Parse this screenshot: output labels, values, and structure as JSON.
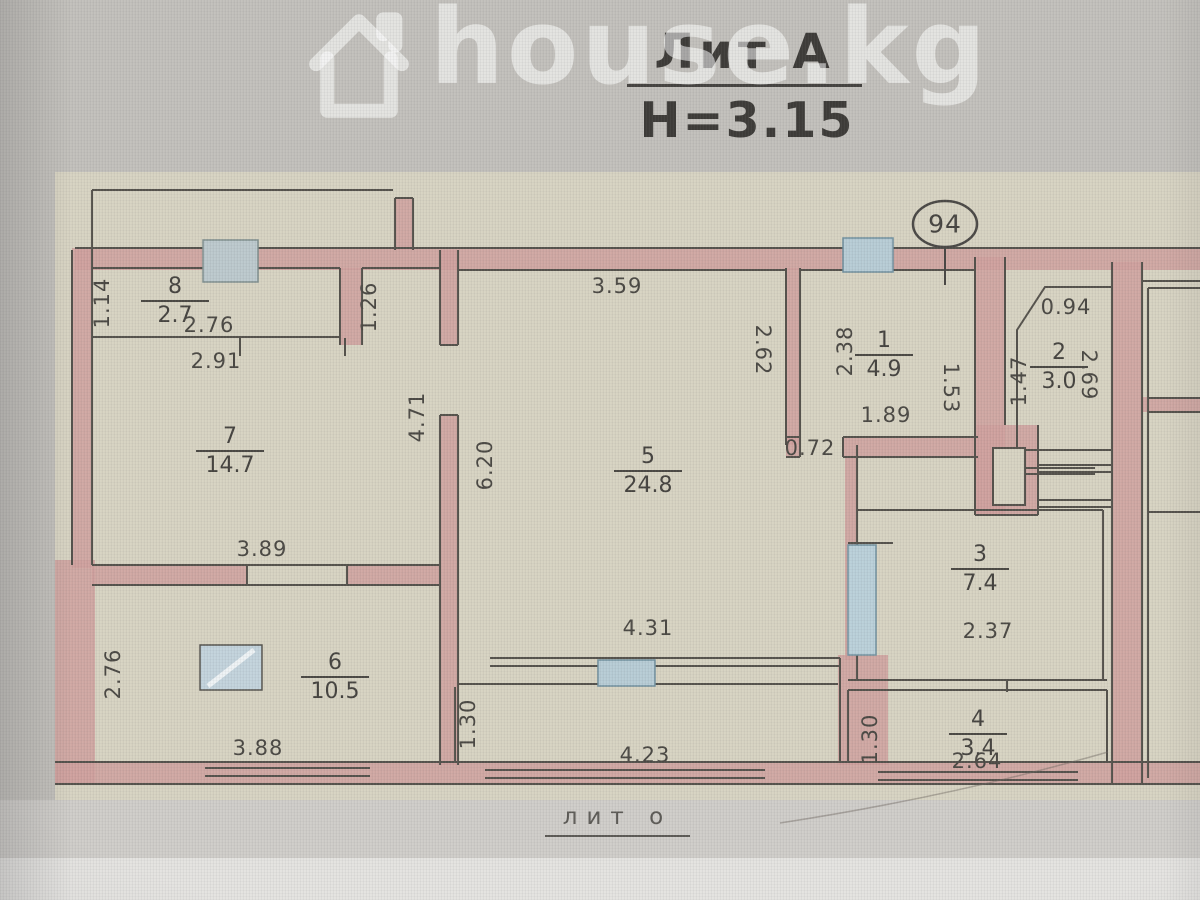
{
  "watermark": {
    "text": "house.kg",
    "icon": "house-icon"
  },
  "title": {
    "liter": "Лит А",
    "height_mark": "H=3.15"
  },
  "plan": {
    "unit_number": "94",
    "footer_liter": "лит о",
    "rooms": [
      {
        "number": "8",
        "area": "2.7"
      },
      {
        "number": "7",
        "area": "14.7"
      },
      {
        "number": "6",
        "area": "10.5"
      },
      {
        "number": "5",
        "area": "24.8"
      },
      {
        "number": "1",
        "area": "4.9"
      },
      {
        "number": "2",
        "area": "3.0"
      },
      {
        "number": "3",
        "area": "7.4"
      },
      {
        "number": "4",
        "area": "3.4"
      }
    ],
    "dimensions": {
      "d114": "1.14",
      "d276a": "2.76",
      "d291": "2.91",
      "d126": "1.26",
      "d471": "4.71",
      "d389": "3.89",
      "d620": "6.20",
      "d359": "3.59",
      "d262": "2.62",
      "d072": "0.72",
      "d238": "2.38",
      "d189": "1.89",
      "d153": "1.53",
      "d094": "0.94",
      "d147": "1.47",
      "d269": "2.69",
      "d431": "4.31",
      "d237": "2.37",
      "d276b": "2.76",
      "d388": "3.88",
      "d130a": "1.30",
      "d423": "4.23",
      "d130b": "1.30",
      "d264": "2.64"
    }
  },
  "colors": {
    "wall_pink": "#cfa09e",
    "window_blue": "#b7ccd5",
    "paper": "#d7d3c2",
    "line": "#55524c"
  }
}
